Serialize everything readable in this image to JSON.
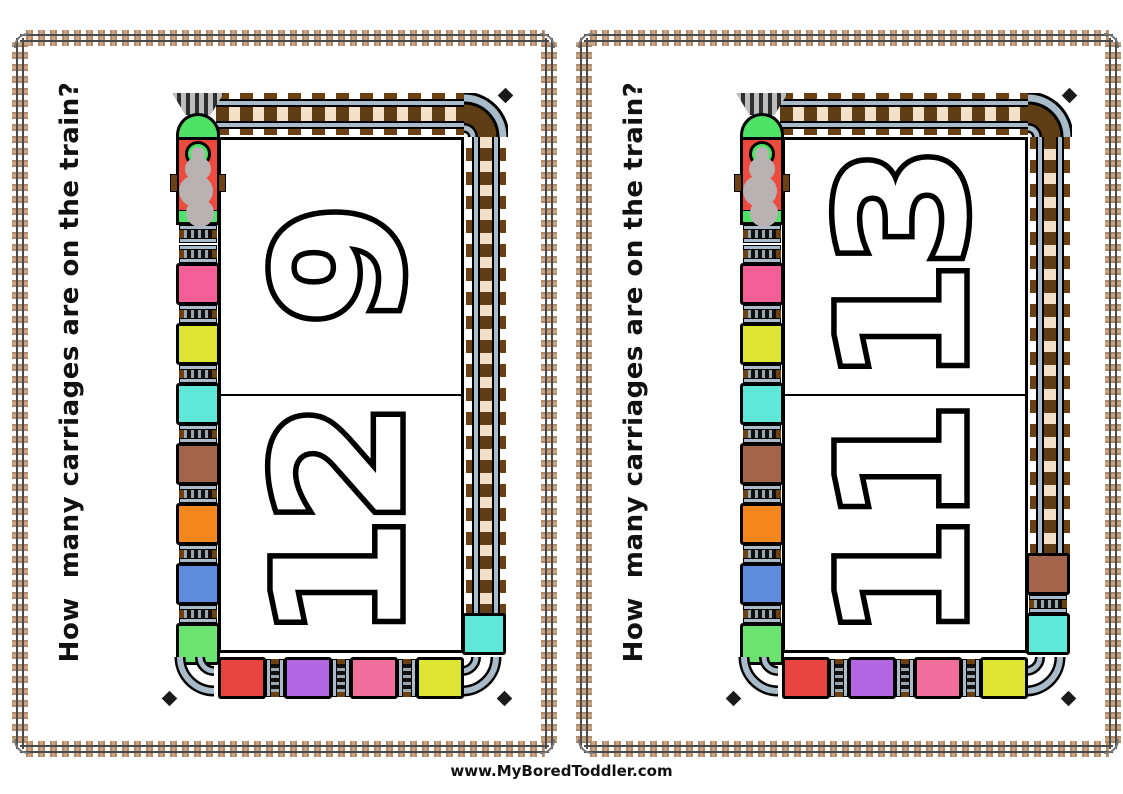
{
  "page": {
    "question": "How  many carriages are on the train?",
    "footer": "www.MyBoredToddler.com"
  },
  "colors": {
    "engine_body": "#ef4a3e",
    "engine_green": "#4ee266",
    "smoke": "#b9b2b2",
    "rail_gray": "#a9bac9",
    "bed_dark": "#5f3d15",
    "bed_light": "#f3e0c8",
    "tab_brown": "#6b4114",
    "number_fill": "#ffffff",
    "number_outline": "#000000"
  },
  "cards": [
    {
      "numbers": [
        "9",
        "12"
      ],
      "left_carriages": [
        "#f45f97",
        "#dde431",
        "#5fe8d8",
        "#a2644a",
        "#f6871e",
        "#5f8cda",
        "#6ce271"
      ],
      "bottom_carriages": [
        "#e94540",
        "#b366e2",
        "#f06f9d",
        "#dde431"
      ],
      "right_carriages": [
        "#5fe8d8"
      ]
    },
    {
      "numbers": [
        "13",
        "11"
      ],
      "left_carriages": [
        "#f45f97",
        "#dde431",
        "#5fe8d8",
        "#a2644a",
        "#f6871e",
        "#5f8cda",
        "#6ce271"
      ],
      "bottom_carriages": [
        "#e94540",
        "#b366e2",
        "#f06f9d",
        "#dde431"
      ],
      "right_carriages": [
        "#a2644a",
        "#5fe8d8"
      ]
    }
  ]
}
